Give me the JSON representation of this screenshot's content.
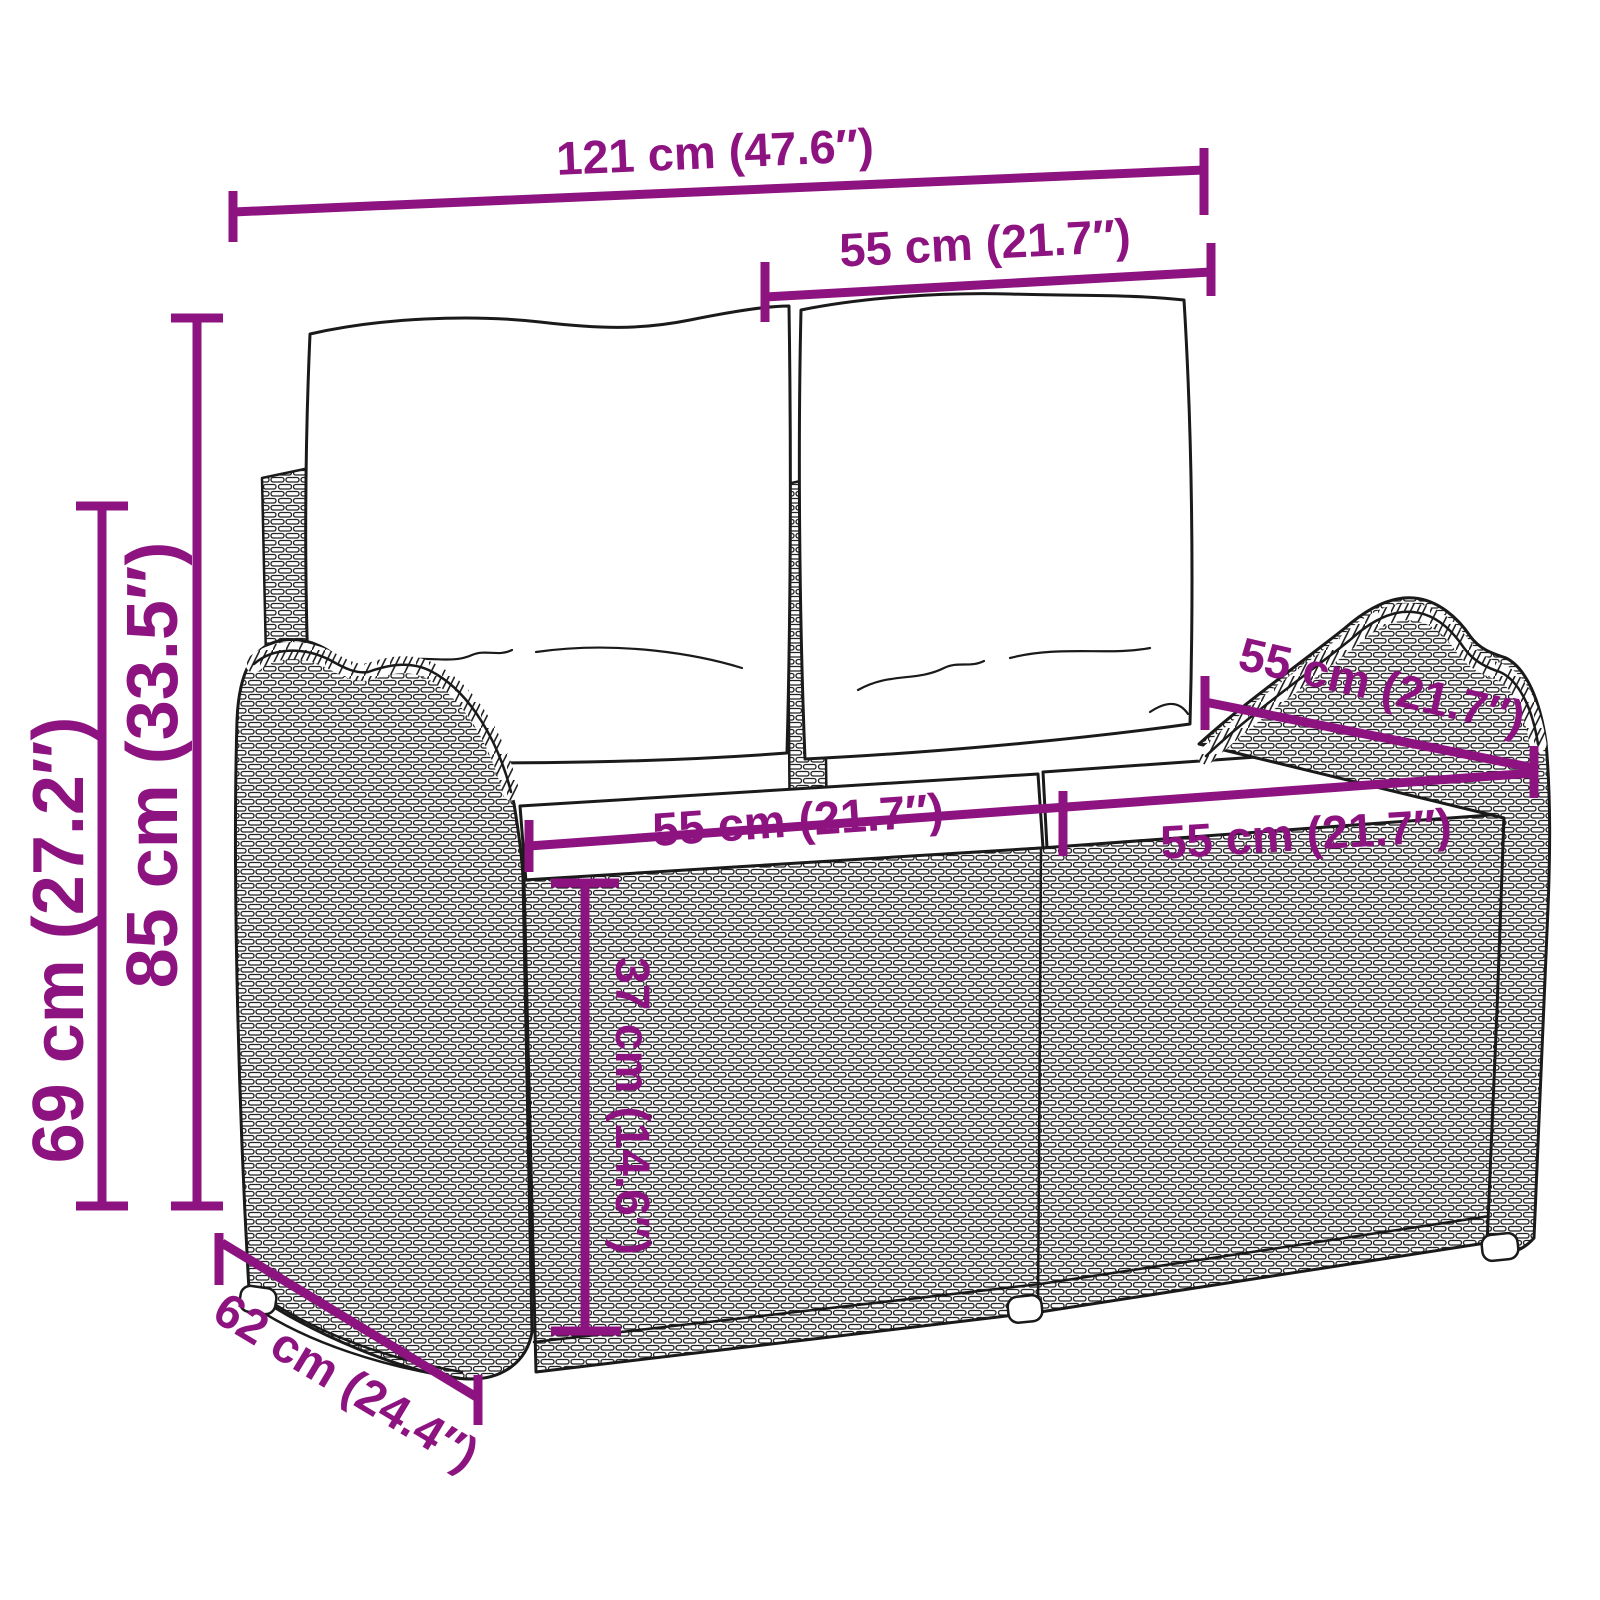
{
  "diagram": {
    "subject": "rattan-garden-bench-with-cushions",
    "colors": {
      "accent": "#8d1480",
      "line_art": "#1a1a1a",
      "background": "#ffffff"
    },
    "dimensions": {
      "overall_width": {
        "label": "121 cm (47.6″)"
      },
      "back_cushion_width": {
        "label": "55 cm (21.7″)"
      },
      "overall_height": {
        "label": "85 cm (33.5″)"
      },
      "armrest_height": {
        "label": "69 cm (27.2″)"
      },
      "seat_width_left": {
        "label": "55 cm (21.7″)"
      },
      "seat_width_right": {
        "label": "55 cm (21.7″)"
      },
      "seat_depth": {
        "label": "55 cm (21.7″)"
      },
      "seat_height": {
        "label": "37 cm (14.6″)"
      },
      "overall_depth": {
        "label": "62 cm (24.4″)"
      }
    }
  }
}
